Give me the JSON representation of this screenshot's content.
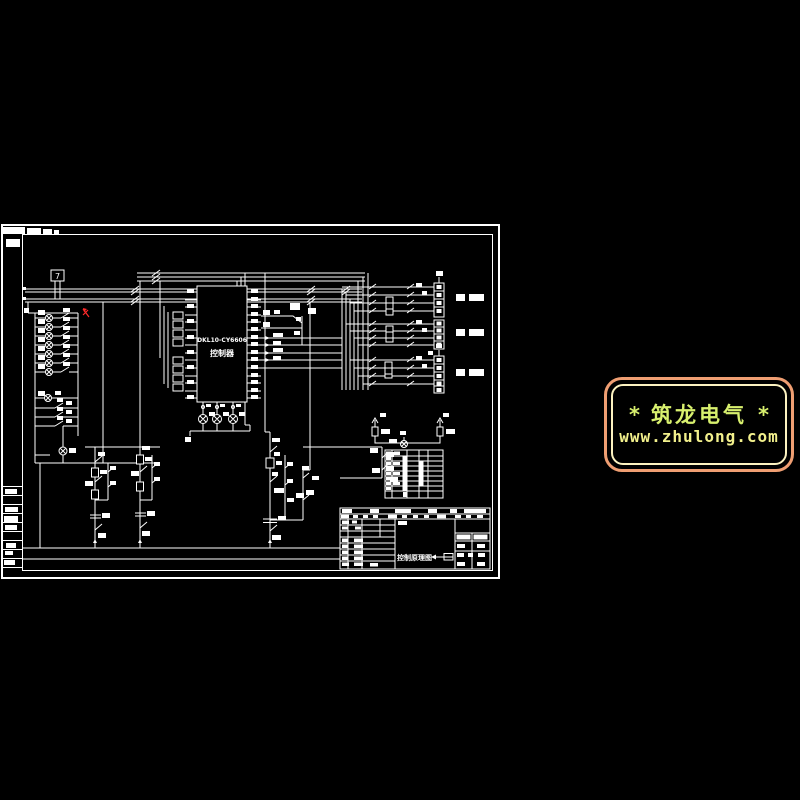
{
  "colors": {
    "background": "#000000",
    "line": "#ffffff",
    "revision_mark": "#ff2a2a",
    "logo_outer_border": "#ef9e72",
    "logo_inner_border": "#fcf2c0",
    "logo_title": "#d8f06e",
    "logo_url": "#f2f08c"
  },
  "schematic": {
    "transformer_box_label": "7",
    "controller": {
      "model": "DKL10-CY6606",
      "name": "控制器"
    },
    "title_block": {
      "drawing_title": "控制原理图"
    }
  },
  "logo": {
    "star_left": "*",
    "star_right": "*",
    "title": "筑龙电气",
    "url": "www.zhulong.com"
  }
}
